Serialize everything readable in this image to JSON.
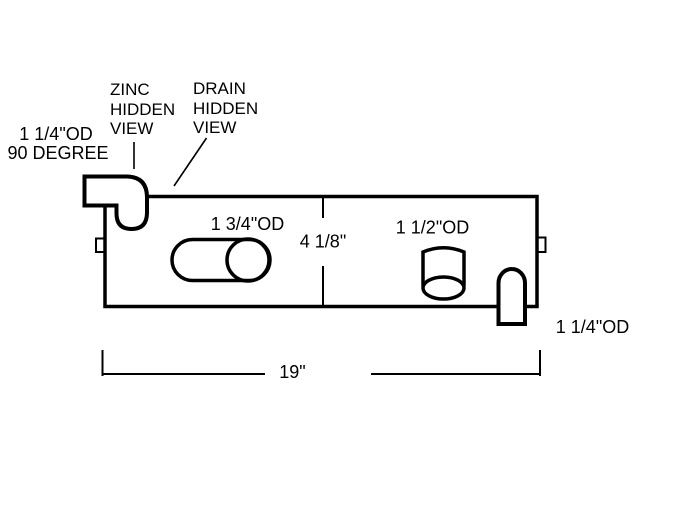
{
  "drawing": {
    "background_color": "#ffffff",
    "line_color": "#000000",
    "callouts": {
      "elbow_fitting": {
        "line1": "1 1/4\"OD",
        "line2": "90 DEGREE"
      },
      "zinc": {
        "lines": [
          "ZINC",
          "HIDDEN",
          "VIEW"
        ]
      },
      "drain": {
        "lines": [
          "DRAIN",
          "HIDDEN",
          "VIEW"
        ]
      },
      "slot_od": "1 3/4\"OD",
      "cylinder_od": "1 1/2\"OD",
      "outlet_od": "1 1/4\"OD"
    },
    "dimensions": {
      "height": "4 1/8\"",
      "length": "19\""
    }
  }
}
